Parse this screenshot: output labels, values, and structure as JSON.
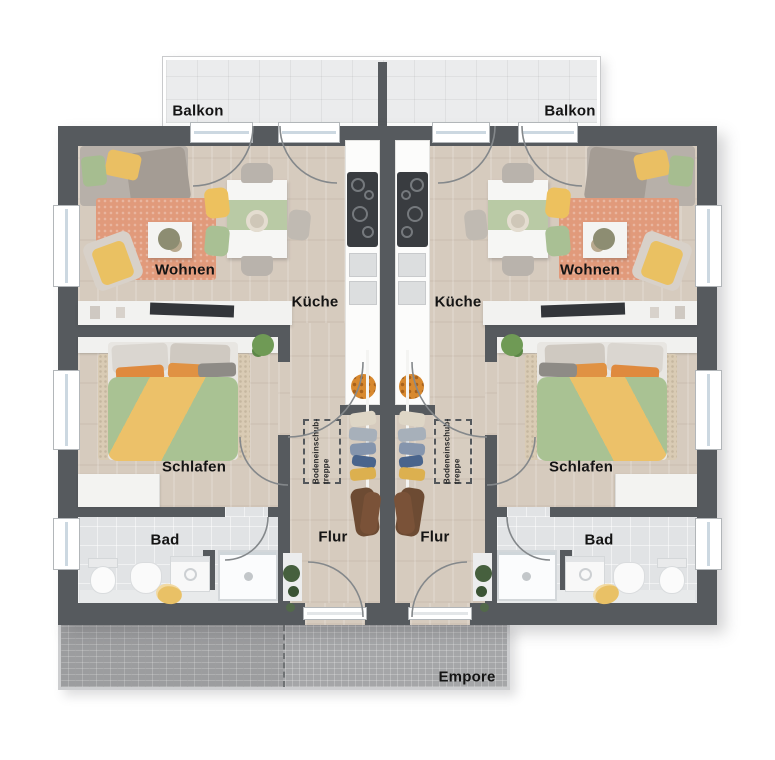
{
  "units": [
    {
      "side": "left",
      "balcony_label": "Balkon",
      "living_label": "Wohnen",
      "kitchen_label": "Küche",
      "bedroom_label": "Schlafen",
      "bath_label": "Bad",
      "hall_label": "Flur",
      "attic_stairs_label_line1": "Bodeneinschub-",
      "attic_stairs_label_line2": "treppe"
    },
    {
      "side": "right",
      "balcony_label": "Balkon",
      "living_label": "Wohnen",
      "kitchen_label": "Küche",
      "bedroom_label": "Schlafen",
      "bath_label": "Bad",
      "hall_label": "Flur",
      "attic_stairs_label_line1": "Bodeneinschub-",
      "attic_stairs_label_line2": "treppe"
    }
  ],
  "gallery_label": "Empore",
  "colors": {
    "wall": "#565a5e",
    "wood_floor": "#d6cbbe",
    "bath_tile": "#e1e3e5",
    "balcony_floor": "#ebeced",
    "gallery_deck": "#a5a6a8",
    "living_rug": "#e19a7b",
    "bedroom_rug": "#d9cbb4",
    "duvet_green": "#a9c293",
    "duvet_yellow": "#ecc169",
    "accent_orange": "#df8a3e",
    "chair_yellow": "#edc15e",
    "coat_brown": "#6d4b33"
  }
}
